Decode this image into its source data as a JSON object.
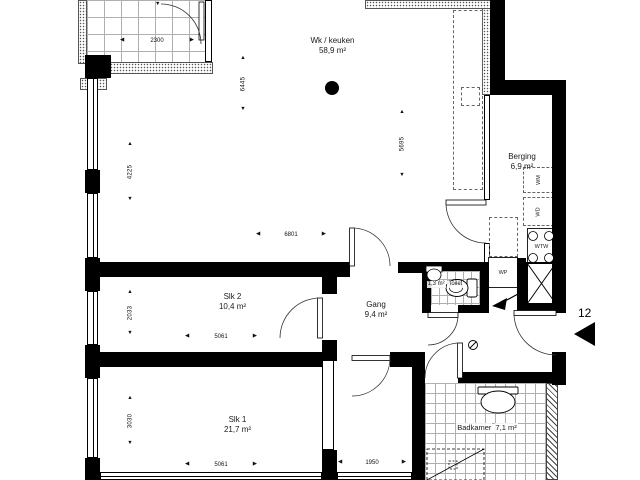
{
  "unit": {
    "number": "12"
  },
  "rooms": {
    "living": {
      "name": "Wk / keuken",
      "area": "58,9 m²"
    },
    "berging": {
      "name": "Berging",
      "area": "6,9 m²"
    },
    "slk2": {
      "name": "Slk 2",
      "area": "10,4 m²"
    },
    "gang": {
      "name": "Gang",
      "area": "9,4 m²"
    },
    "toilet": {
      "name": "Toilet",
      "area": "1,3 m²"
    },
    "slk1": {
      "name": "Slk 1",
      "area": "21,7 m²"
    },
    "badkamer": {
      "name": "Badkamer",
      "area": "7,1 m²"
    }
  },
  "appliances": {
    "wm": "WM",
    "wd": "WD",
    "wtw": "WTW",
    "wp": "WP"
  },
  "dims": {
    "balcony_width": "2300",
    "living_depth": "6445",
    "living_left": "4225",
    "living_right": "5695",
    "living_width": "6801",
    "slk2_depth": "2033",
    "slk2_width": "5061",
    "slk1_depth": "3030",
    "slk1_width": "5061",
    "entry_width": "1950"
  },
  "icons": {
    "arrow_left": "◀",
    "arrow_right": "▶",
    "arrow_up": "▲",
    "arrow_down": "▼"
  },
  "colors": {
    "wall": "#000000",
    "line": "#444444",
    "paper": "#ffffff"
  }
}
